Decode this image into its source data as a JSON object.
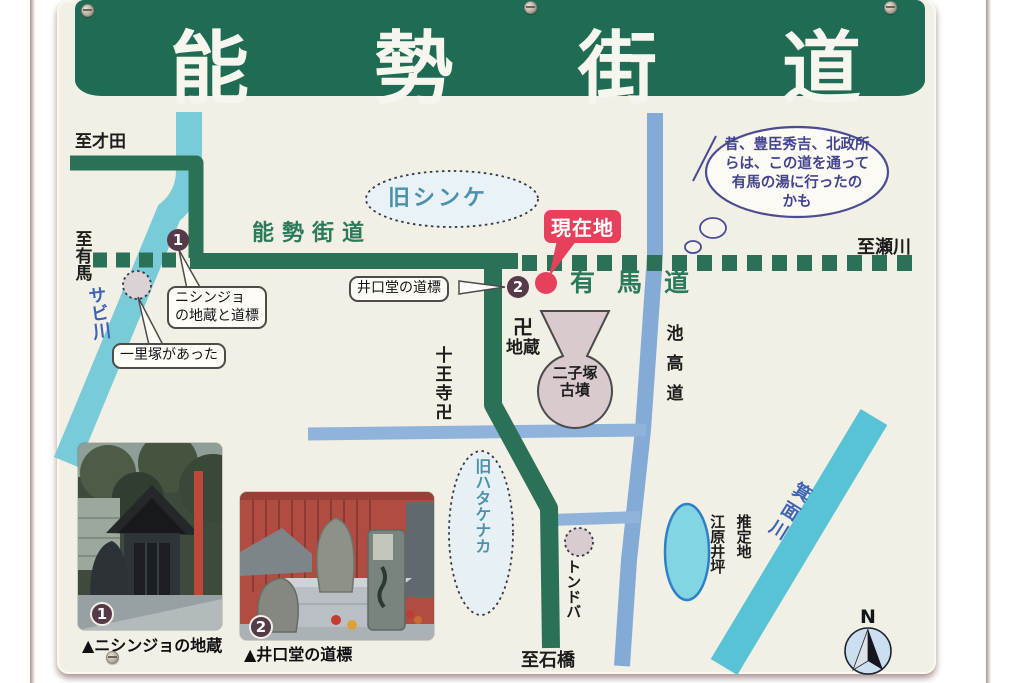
{
  "header": {
    "title": "能勢街道"
  },
  "roads": {
    "nose_kaido": "能勢街道",
    "arima_michi": "有馬道",
    "ikekodo": "池高道"
  },
  "rivers": {
    "sabi": "サビ川",
    "minoh": "箕面川"
  },
  "destinations": {
    "saida": "至才田",
    "arima": "至有馬",
    "segawa": "至瀬川",
    "ishibashi": "至石橋"
  },
  "areas": {
    "kyu_shinke": "旧シンケ",
    "kyu_hatakenaka": "旧ハタケナカ",
    "tondoba": "トンドバ"
  },
  "landmarks": {
    "manji": "卍",
    "jizo": "地蔵",
    "juoji": "十王寺卍",
    "futagozuka_line1": "二子塚",
    "futagozuka_line2": "古墳",
    "suitei_col1": "推定地",
    "suitei_col2": "江原井坪"
  },
  "callouts": {
    "nishinjo_line1": "ニシンジョ",
    "nishinjo_line2": "の地蔵と道標",
    "ichirizuka": "一里塚があった",
    "iguchido": "井口堂の道標",
    "current_location": "現在地"
  },
  "bubble": {
    "line1": "昔、豊臣秀吉、北政所",
    "line2": "らは、この道を通って",
    "line3": "有馬の湯に行ったの",
    "line4": "かも"
  },
  "badges": {
    "one": "1",
    "two": "2"
  },
  "photos": {
    "caption1": "▲ニシンジョの地蔵",
    "caption2": "▲井口堂の道標"
  },
  "compass": {
    "north": "N"
  },
  "colors": {
    "header_green": "#1f6b53",
    "road_green": "#2b7157",
    "label_green": "#2b7a5c",
    "river_cyan": "#7acbd8",
    "minoh_cyan": "#59c3d6",
    "road_blue": "#83abd6",
    "accent_red": "#e6405c",
    "badge_plum": "#573a49",
    "bubble_blue": "#4a4b92",
    "sign_cream": "#f2efe5"
  }
}
